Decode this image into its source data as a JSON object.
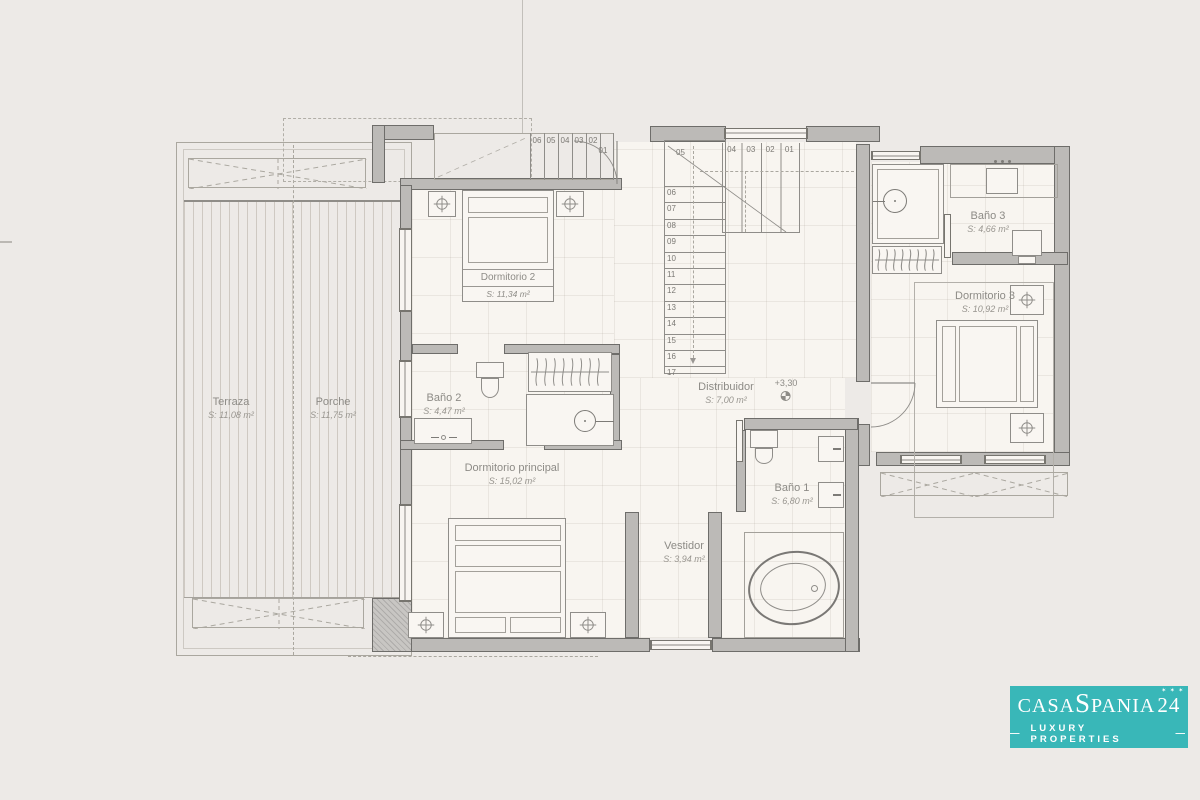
{
  "page": {
    "background": "#edeae7"
  },
  "plan": {
    "rooms": {
      "terraza": {
        "label": "Terraza",
        "area": "S: 11,08 m²"
      },
      "porche": {
        "label": "Porche",
        "area": "S: 11,75 m²"
      },
      "dormitorio2": {
        "label": "Dormitorio 2",
        "area": "S: 11,34 m²"
      },
      "bano2": {
        "label": "Baño 2",
        "area": "S: 4,47 m²"
      },
      "principal": {
        "label": "Dormitorio principal",
        "area": "S: 15,02 m²"
      },
      "distribuidor": {
        "label": "Distribuidor",
        "area": "S: 7,00 m²"
      },
      "bano1": {
        "label": "Baño 1",
        "area": "S: 6,80 m²"
      },
      "vestidor": {
        "label": "Vestidor",
        "area": "S: 3,94 m²"
      },
      "dormitorio3": {
        "label": "Dormitorio 3",
        "area": "S: 10,92 m²"
      },
      "bano3": {
        "label": "Baño 3",
        "area": "S: 4,66 m²"
      }
    },
    "level_marker": "+3,30",
    "stairs": {
      "entry_run": [
        "06",
        "05",
        "04",
        "03",
        "02"
      ],
      "entry_last": "01",
      "upper_run": [
        "04",
        "03",
        "02",
        "01"
      ],
      "winder": "05",
      "flight": [
        "06",
        "07",
        "08",
        "09",
        "10",
        "11",
        "12",
        "13",
        "14",
        "15",
        "16",
        "17"
      ]
    },
    "colors": {
      "wall_fill": "#bcbab7",
      "wall_edge": "#6e6d6a",
      "linework": "#9a9793",
      "label_text": "#8d8b86"
    }
  },
  "logo": {
    "part1": "CASA",
    "part2": "S",
    "part3": "PANIA",
    "number": "24",
    "stars": "✶ ✶ ✶",
    "dash": "—",
    "tagline": "LUXURY PROPERTIES",
    "bg_color": "#39b7b8",
    "text_color": "#ffffff"
  }
}
